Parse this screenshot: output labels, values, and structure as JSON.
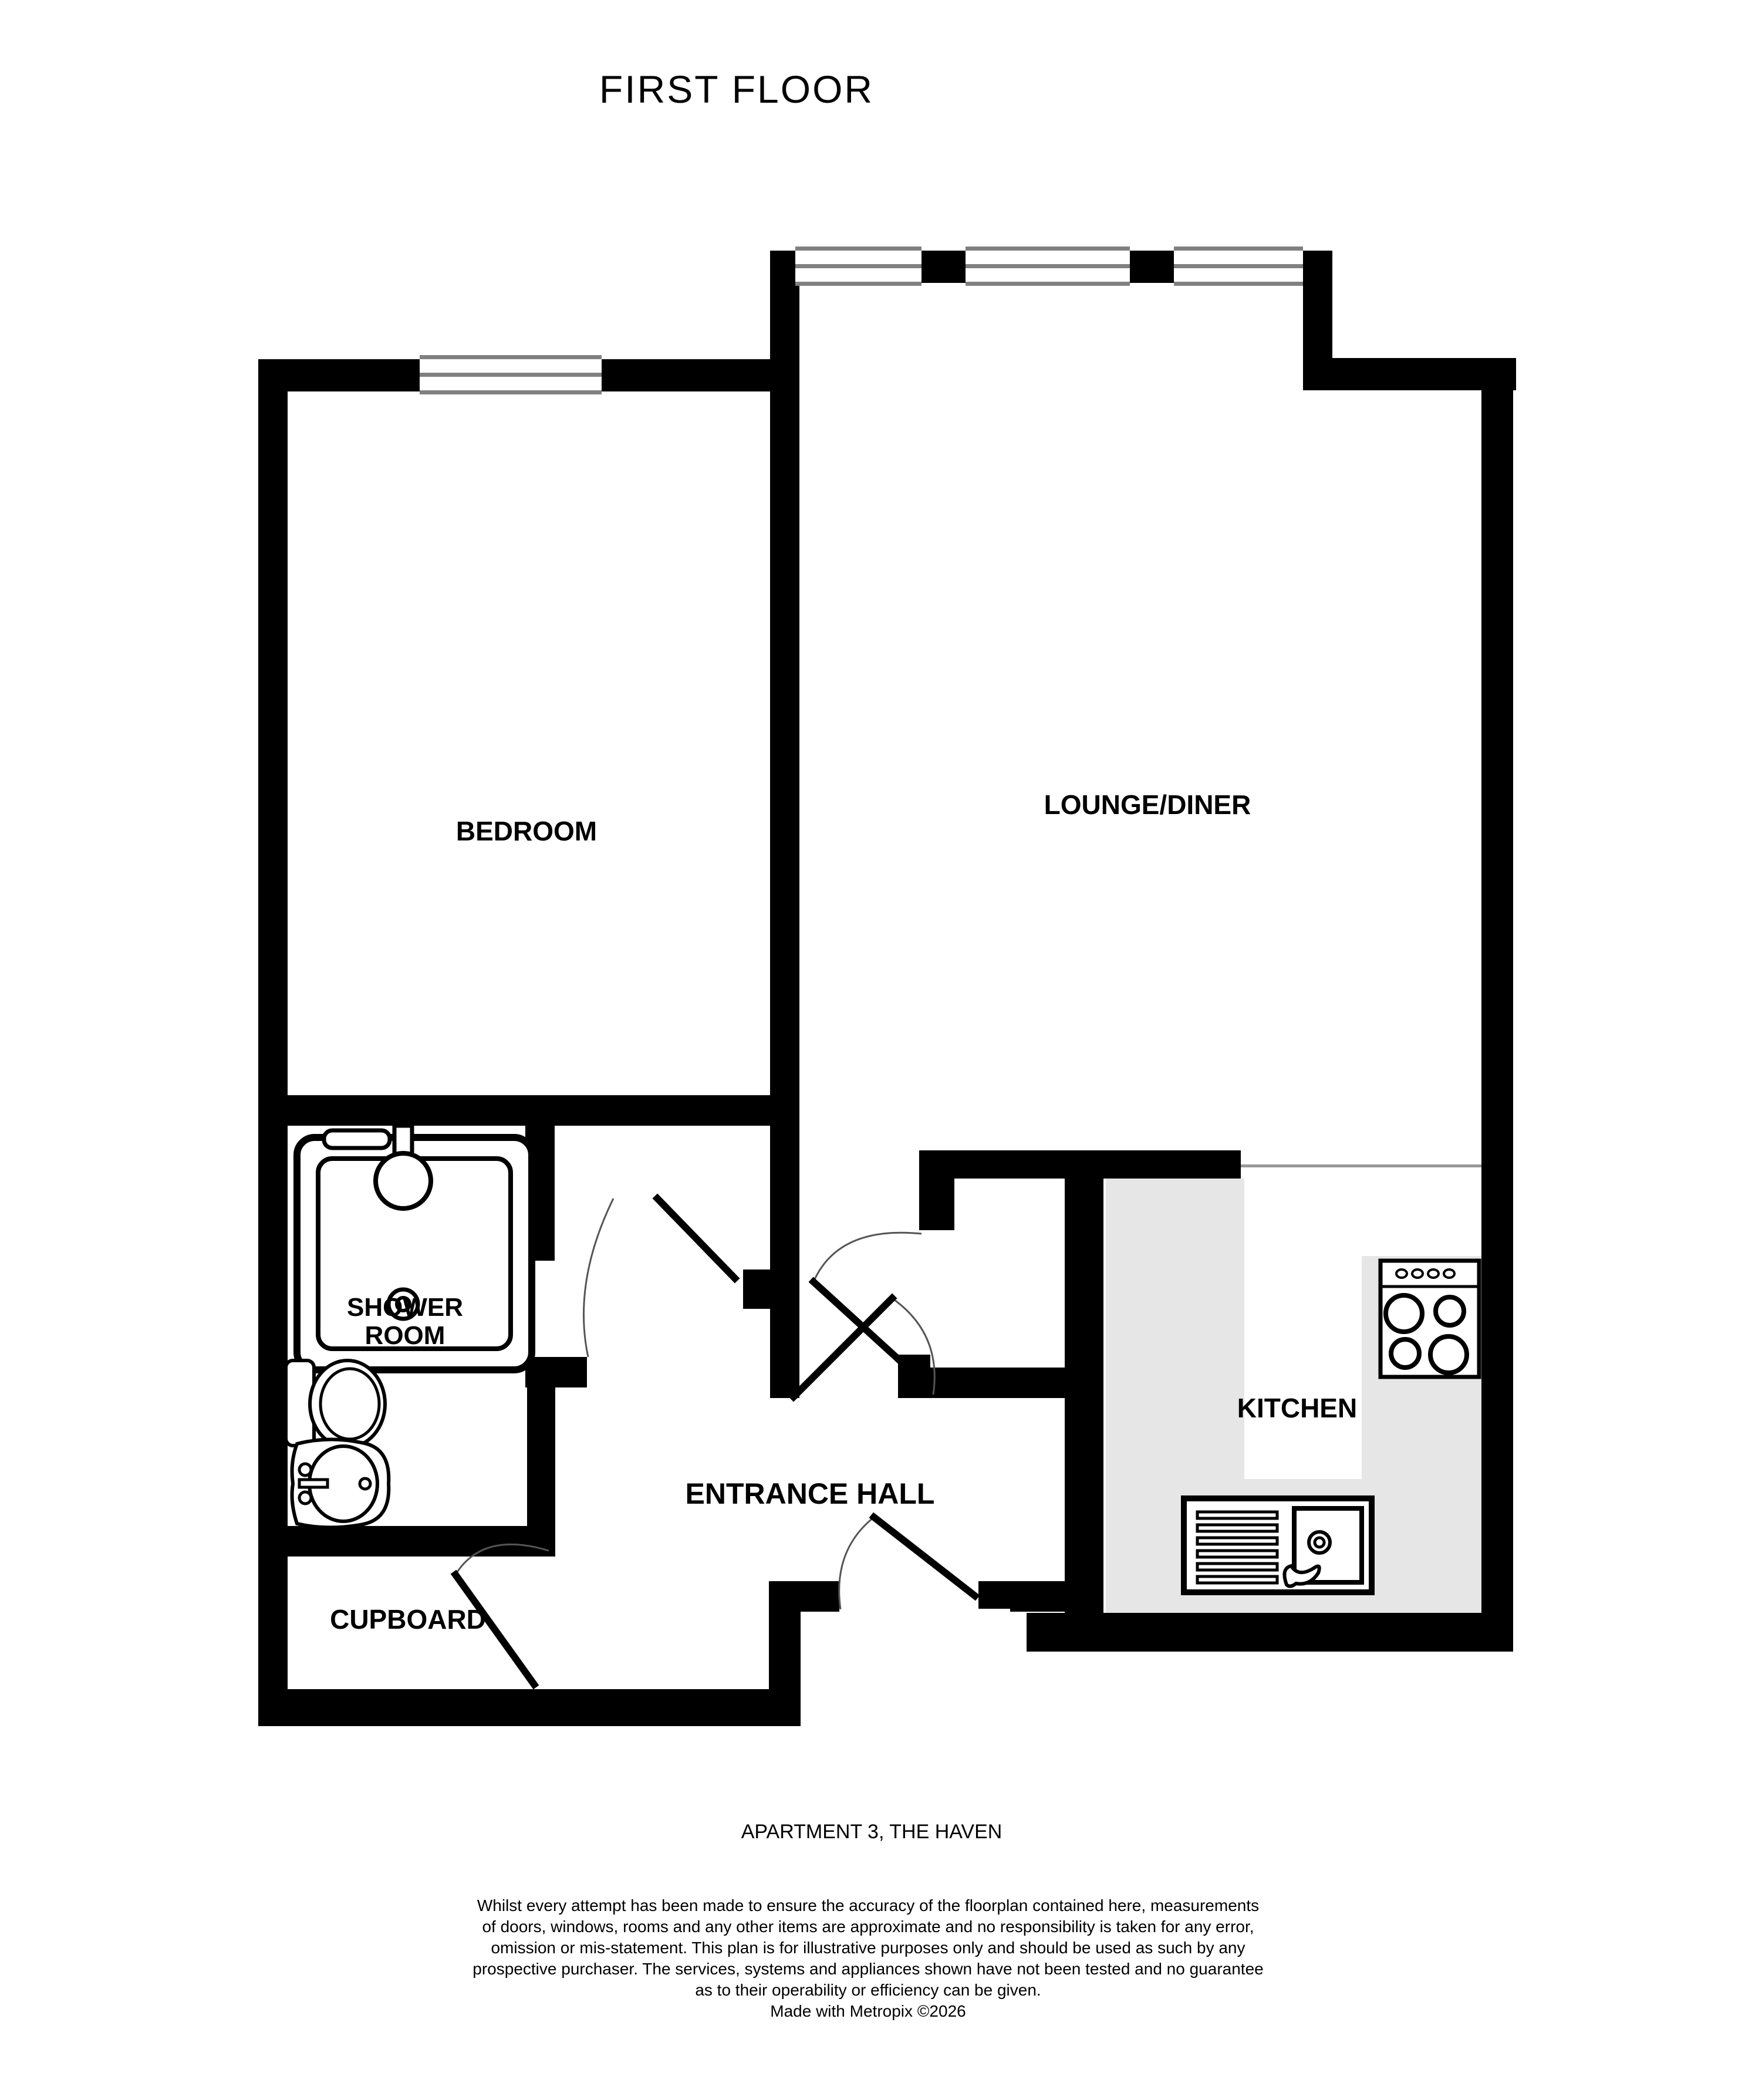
{
  "title": "FIRST FLOOR",
  "rooms": {
    "bedroom": "BEDROOM",
    "lounge": "LOUNGE/DINER",
    "shower_line1": "SHOWER",
    "shower_line2": "ROOM",
    "kitchen": "KITCHEN",
    "hall": "ENTRANCE HALL",
    "cupboard": "CUPBOARD"
  },
  "footer": {
    "address": "APARTMENT 3, THE HAVEN",
    "disclaimer_lines": [
      "Whilst every attempt has been made to ensure the accuracy of the floorplan contained here, measurements",
      "of doors, windows, rooms and any other items are approximate and no responsibility is taken for any error,",
      "omission or mis-statement. This plan is for illustrative purposes only and should be used as such by any",
      "prospective purchaser. The services, systems and appliances shown have not been tested and no guarantee",
      "as to their operability or efficiency can be given.",
      "Made with Metropix ©2026"
    ]
  },
  "colors": {
    "wall": "#000000",
    "counter": "#e6e6e6",
    "window_line": "#808080",
    "open_boundary_line": "#999999"
  }
}
